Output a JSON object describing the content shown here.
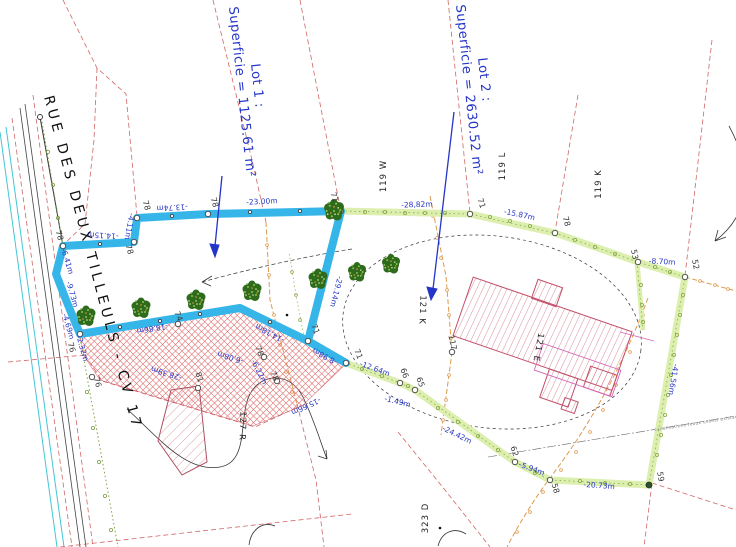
{
  "lot1": {
    "line1": "Lot 1 :",
    "line2": "Superficie = 1125.61 m²"
  },
  "lot2": {
    "line1": "Lot 2 :",
    "line2": "Superficie = 2630.52 m²"
  },
  "street": "RUE DES DEUX TILLEULS - CV 17",
  "parcels": [
    "119 W",
    "119 L",
    "119 K",
    "121 K",
    "121 E",
    "127 R",
    "323 D"
  ],
  "measurements": [
    "-13.74m",
    "-23.00m",
    "-4.11m",
    "-14.15m",
    "-6.41m",
    "-9.73m",
    "-4.69m",
    "-2.32m",
    "-18.86m",
    "-28.39m",
    "-6.08m",
    "-6.22m",
    "-15.66m",
    "-14.18m",
    "-8.98m",
    "-29.14m",
    "-12.64m",
    "-1.49m",
    "-24.42m",
    "-5.94m",
    "-20.73m",
    "-41.56m",
    "-8.70m",
    "-15.87m",
    "-28,82m"
  ],
  "vertices": [
    "78",
    "78",
    "78",
    "78",
    "71",
    "71",
    "78",
    "53",
    "52",
    "59",
    "58",
    "62",
    "65",
    "66",
    "71",
    "71",
    "117",
    "81",
    "76",
    "76",
    "74",
    "78",
    "78"
  ],
  "notes": {
    "sewer": "canalisations (eaux usées) existantes"
  },
  "colors": {
    "lot1_boundary": "#35b5e8",
    "lot2_boundary": "#dcefae",
    "label_blue": "#2535c8",
    "parcel_dash": "#d06666",
    "hatch_red": "#cc5566",
    "tree_green": "#2e6b1d",
    "fence_orange": "#dd9a4e"
  }
}
